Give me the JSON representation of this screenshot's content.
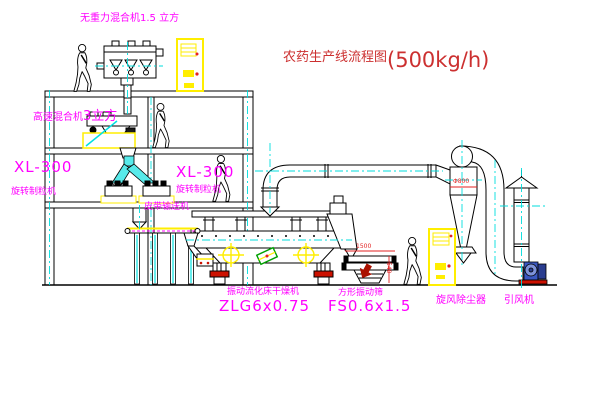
{
  "title": {
    "text": "农药生产线流程图",
    "capacity": "(500kg/h)"
  },
  "equipment_labels": {
    "gravity_mixer": "无重力混合机1.5 立方",
    "high_speed_mixer_name": "高速混合机",
    "high_speed_mixer_size": "3立方",
    "granulator_left_model": "XL-300",
    "granulator_left_name": "旋转制粒机",
    "granulator_right_model": "XL-300",
    "granulator_right_name": "旋转制粒机",
    "belt_conveyor": "皮带输送机",
    "fluid_bed_dryer_name": "振动流化床干燥机",
    "fluid_bed_dryer_model": "ZLG6x0.75",
    "square_sieve_name": "方形振动筛",
    "square_sieve_model": "FS0.6x1.5",
    "cyclone": "旋风除尘器",
    "induced_draft_fan": "引风机"
  },
  "dimensions": {
    "cyclone_diameter": "Φ800",
    "sieve_length": "1500",
    "sieve_height": "540"
  },
  "colors": {
    "label_magenta": "#ff00ff",
    "title_red": "#cc3030",
    "line_black": "#000000",
    "centerline_cyan": "#00dddd",
    "equipment_yellow": "#ffee00",
    "dimension_red": "#e32222",
    "base_red": "#cc1100",
    "fan_blue": "#3a57c0",
    "motor_green": "#00a000"
  }
}
